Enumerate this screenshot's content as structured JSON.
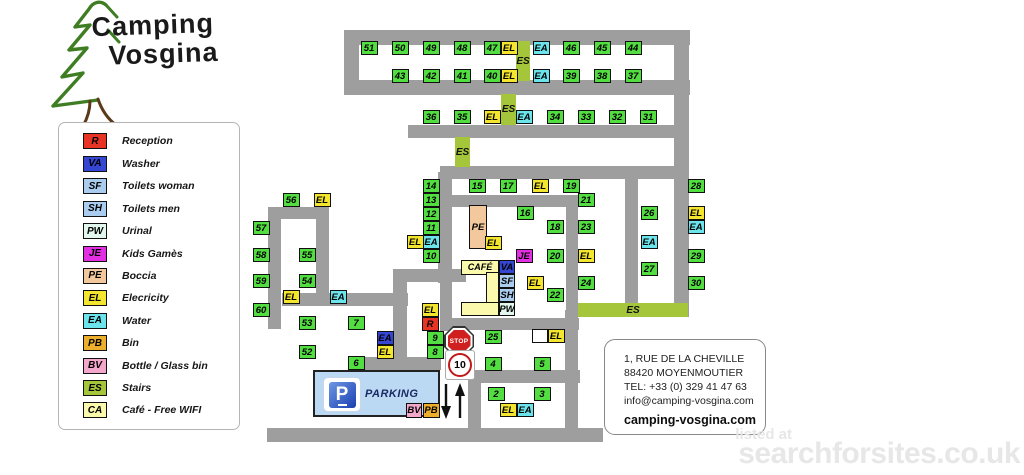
{
  "logo": {
    "line1": "Camping",
    "line2": "Vosgina"
  },
  "legend": {
    "items": [
      {
        "code": "R",
        "type": "R",
        "label": "Reception"
      },
      {
        "code": "VA",
        "type": "VA",
        "label": "Washer"
      },
      {
        "code": "SF",
        "type": "SF",
        "label": "Toilets woman"
      },
      {
        "code": "SH",
        "type": "SH",
        "label": "Toilets men"
      },
      {
        "code": "PW",
        "type": "PW",
        "label": "Urinal"
      },
      {
        "code": "JE",
        "type": "JE",
        "label": "Kids Gamès"
      },
      {
        "code": "PE",
        "type": "PE",
        "label": "Boccia"
      },
      {
        "code": "EL",
        "type": "EL",
        "label": "Elecricity"
      },
      {
        "code": "EA",
        "type": "EA",
        "label": "Water"
      },
      {
        "code": "PB",
        "type": "PB",
        "label": "Bin"
      },
      {
        "code": "BV",
        "type": "BV",
        "label": "Bottle / Glass bin"
      },
      {
        "code": "ES",
        "type": "ES",
        "label": "Stairs"
      },
      {
        "code": "CA",
        "type": "CA",
        "label": "Café - Free WIFI"
      }
    ]
  },
  "map": {
    "roads": [
      [
        344,
        30,
        346,
        15
      ],
      [
        344,
        80,
        346,
        15
      ],
      [
        344,
        30,
        15,
        65
      ],
      [
        674,
        30,
        15,
        287
      ],
      [
        408,
        125,
        280,
        13
      ],
      [
        440,
        166,
        248,
        13
      ],
      [
        625,
        172,
        13,
        131
      ],
      [
        452,
        195,
        127,
        12
      ],
      [
        566,
        195,
        12,
        135
      ],
      [
        440,
        318,
        139,
        12
      ],
      [
        438,
        172,
        14,
        111
      ],
      [
        393,
        269,
        73,
        13
      ],
      [
        393,
        276,
        14,
        95
      ],
      [
        282,
        293,
        126,
        13
      ],
      [
        268,
        207,
        61,
        12
      ],
      [
        268,
        207,
        13,
        122
      ],
      [
        316,
        207,
        13,
        99
      ],
      [
        352,
        357,
        89,
        13
      ],
      [
        440,
        269,
        12,
        62
      ],
      [
        565,
        310,
        13,
        126
      ],
      [
        468,
        370,
        112,
        13
      ],
      [
        468,
        377,
        13,
        58
      ],
      [
        267,
        428,
        336,
        14
      ]
    ],
    "stairs": [
      {
        "x": 516,
        "y": 41,
        "w": 14,
        "h": 40,
        "label": "ES"
      },
      {
        "x": 501,
        "y": 94,
        "w": 15,
        "h": 31,
        "label": "ES"
      },
      {
        "x": 455,
        "y": 137,
        "w": 15,
        "h": 30,
        "label": "ES"
      },
      {
        "x": 578,
        "y": 303,
        "w": 110,
        "h": 14,
        "label": "ES"
      }
    ],
    "boxes": [
      {
        "l": "51",
        "t": "P",
        "x": 369,
        "y": 48
      },
      {
        "l": "50",
        "t": "P",
        "x": 400,
        "y": 48
      },
      {
        "l": "49",
        "t": "P",
        "x": 431,
        "y": 48
      },
      {
        "l": "48",
        "t": "P",
        "x": 462,
        "y": 48
      },
      {
        "l": "47",
        "t": "P",
        "x": 492,
        "y": 48
      },
      {
        "l": "EL",
        "t": "EL",
        "x": 509,
        "y": 48
      },
      {
        "l": "EA",
        "t": "EA",
        "x": 541,
        "y": 48
      },
      {
        "l": "46",
        "t": "P",
        "x": 571,
        "y": 48
      },
      {
        "l": "45",
        "t": "P",
        "x": 602,
        "y": 48
      },
      {
        "l": "44",
        "t": "P",
        "x": 633,
        "y": 48
      },
      {
        "l": "43",
        "t": "P",
        "x": 400,
        "y": 76
      },
      {
        "l": "42",
        "t": "P",
        "x": 431,
        "y": 76
      },
      {
        "l": "41",
        "t": "P",
        "x": 462,
        "y": 76
      },
      {
        "l": "40",
        "t": "P",
        "x": 492,
        "y": 76
      },
      {
        "l": "EL",
        "t": "EL",
        "x": 509,
        "y": 76
      },
      {
        "l": "EA",
        "t": "EA",
        "x": 541,
        "y": 76
      },
      {
        "l": "39",
        "t": "P",
        "x": 571,
        "y": 76
      },
      {
        "l": "38",
        "t": "P",
        "x": 602,
        "y": 76
      },
      {
        "l": "37",
        "t": "P",
        "x": 633,
        "y": 76
      },
      {
        "l": "36",
        "t": "P",
        "x": 431,
        "y": 117
      },
      {
        "l": "35",
        "t": "P",
        "x": 462,
        "y": 117
      },
      {
        "l": "EL",
        "t": "EL",
        "x": 492,
        "y": 117
      },
      {
        "l": "EA",
        "t": "EA",
        "x": 524,
        "y": 117
      },
      {
        "l": "34",
        "t": "P",
        "x": 555,
        "y": 117
      },
      {
        "l": "33",
        "t": "P",
        "x": 586,
        "y": 117
      },
      {
        "l": "32",
        "t": "P",
        "x": 617,
        "y": 117
      },
      {
        "l": "31",
        "t": "P",
        "x": 648,
        "y": 117
      },
      {
        "l": "14",
        "t": "P",
        "x": 431,
        "y": 186
      },
      {
        "l": "15",
        "t": "P",
        "x": 477,
        "y": 186
      },
      {
        "l": "17",
        "t": "P",
        "x": 508,
        "y": 186
      },
      {
        "l": "EL",
        "t": "EL",
        "x": 540,
        "y": 186
      },
      {
        "l": "19",
        "t": "P",
        "x": 571,
        "y": 186
      },
      {
        "l": "28",
        "t": "P",
        "x": 696,
        "y": 186
      },
      {
        "l": "13",
        "t": "P",
        "x": 431,
        "y": 200
      },
      {
        "l": "21",
        "t": "P",
        "x": 586,
        "y": 200
      },
      {
        "l": "56",
        "t": "P",
        "x": 291,
        "y": 200
      },
      {
        "l": "EL",
        "t": "EL",
        "x": 322,
        "y": 200
      },
      {
        "l": "12",
        "t": "P",
        "x": 431,
        "y": 214
      },
      {
        "l": "16",
        "t": "P",
        "x": 525,
        "y": 213
      },
      {
        "l": "26",
        "t": "P",
        "x": 649,
        "y": 213
      },
      {
        "l": "EL",
        "t": "EL",
        "x": 696,
        "y": 213
      },
      {
        "l": "11",
        "t": "P",
        "x": 431,
        "y": 228
      },
      {
        "l": "18",
        "t": "P",
        "x": 555,
        "y": 227
      },
      {
        "l": "23",
        "t": "P",
        "x": 586,
        "y": 227
      },
      {
        "l": "EA",
        "t": "EA",
        "x": 696,
        "y": 227
      },
      {
        "l": "57",
        "t": "P",
        "x": 261,
        "y": 228
      },
      {
        "l": "PE",
        "t": "PE",
        "x": 478,
        "y": 227,
        "w": 18,
        "h": 44
      },
      {
        "l": "EL",
        "t": "EL",
        "x": 415,
        "y": 242
      },
      {
        "l": "EA",
        "t": "EA",
        "x": 431,
        "y": 242
      },
      {
        "l": "EA",
        "t": "EA",
        "x": 649,
        "y": 242
      },
      {
        "l": "EL",
        "t": "EL",
        "x": 493,
        "y": 243
      },
      {
        "l": "10",
        "t": "P",
        "x": 431,
        "y": 256
      },
      {
        "l": "JE",
        "t": "JE",
        "x": 524,
        "y": 256
      },
      {
        "l": "20",
        "t": "P",
        "x": 555,
        "y": 256
      },
      {
        "l": "EL",
        "t": "EL",
        "x": 586,
        "y": 256
      },
      {
        "l": "29",
        "t": "P",
        "x": 696,
        "y": 256
      },
      {
        "l": "58",
        "t": "P",
        "x": 261,
        "y": 255
      },
      {
        "l": "55",
        "t": "P",
        "x": 307,
        "y": 255
      },
      {
        "l": "CAFÉ",
        "t": "CA",
        "x": 480,
        "y": 267,
        "w": 38,
        "h": 15
      },
      {
        "l": "VA",
        "t": "VA",
        "x": 507,
        "y": 267,
        "w": 16,
        "h": 14
      },
      {
        "l": "27",
        "t": "P",
        "x": 649,
        "y": 269
      },
      {
        "l": "59",
        "t": "P",
        "x": 261,
        "y": 281
      },
      {
        "l": "54",
        "t": "P",
        "x": 307,
        "y": 281
      },
      {
        "l": "SF",
        "t": "SF",
        "x": 507,
        "y": 281,
        "w": 16,
        "h": 14
      },
      {
        "l": "EL",
        "t": "EL",
        "x": 535,
        "y": 283
      },
      {
        "l": "24",
        "t": "P",
        "x": 586,
        "y": 283
      },
      {
        "l": "30",
        "t": "P",
        "x": 696,
        "y": 283
      },
      {
        "l": "",
        "t": "CA",
        "x": 492,
        "y": 288,
        "w": 13,
        "h": 32
      },
      {
        "l": "EL",
        "t": "EL",
        "x": 291,
        "y": 297
      },
      {
        "l": "EA",
        "t": "EA",
        "x": 338,
        "y": 297
      },
      {
        "l": "SH",
        "t": "SH",
        "x": 507,
        "y": 295,
        "w": 16,
        "h": 14
      },
      {
        "l": "22",
        "t": "P",
        "x": 555,
        "y": 295
      },
      {
        "l": "60",
        "t": "P",
        "x": 261,
        "y": 310
      },
      {
        "l": "EL",
        "t": "EL",
        "x": 430,
        "y": 310
      },
      {
        "l": "",
        "t": "CA",
        "x": 480,
        "y": 309,
        "w": 38,
        "h": 14
      },
      {
        "l": "PW",
        "t": "PW",
        "x": 507,
        "y": 309,
        "w": 16,
        "h": 14
      },
      {
        "l": "53",
        "t": "P",
        "x": 307,
        "y": 323
      },
      {
        "l": "7",
        "t": "P",
        "x": 356,
        "y": 323
      },
      {
        "l": "R",
        "t": "R",
        "x": 430,
        "y": 324
      },
      {
        "l": "25",
        "t": "P",
        "x": 493,
        "y": 337
      },
      {
        "l": "",
        "t": "WHITE",
        "x": 540,
        "y": 336,
        "w": 16
      },
      {
        "l": "EL",
        "t": "EL",
        "x": 556,
        "y": 336
      },
      {
        "l": "EA",
        "t": "EAB",
        "x": 385,
        "y": 338
      },
      {
        "l": "9",
        "t": "P",
        "x": 435,
        "y": 338
      },
      {
        "l": "EL",
        "t": "EL",
        "x": 385,
        "y": 352
      },
      {
        "l": "8",
        "t": "P",
        "x": 435,
        "y": 352
      },
      {
        "l": "52",
        "t": "P",
        "x": 307,
        "y": 352
      },
      {
        "l": "6",
        "t": "P",
        "x": 356,
        "y": 363
      },
      {
        "l": "4",
        "t": "P",
        "x": 493,
        "y": 364
      },
      {
        "l": "5",
        "t": "P",
        "x": 542,
        "y": 364
      },
      {
        "l": "2",
        "t": "P",
        "x": 496,
        "y": 394
      },
      {
        "l": "3",
        "t": "P",
        "x": 542,
        "y": 394
      },
      {
        "l": "EL",
        "t": "EL",
        "x": 508,
        "y": 410
      },
      {
        "l": "EA",
        "t": "EA",
        "x": 525,
        "y": 410
      },
      {
        "l": "BV",
        "t": "BV",
        "x": 414,
        "y": 410,
        "w": 16,
        "h": 15
      },
      {
        "l": "PB",
        "t": "PB",
        "x": 431,
        "y": 410,
        "w": 17,
        "h": 15
      }
    ],
    "parking": {
      "label": "PARKING"
    },
    "stop_label": "STOP",
    "speed_label": "10"
  },
  "contact": {
    "lines": [
      "1, RUE DE LA CHEVILLE",
      "88420 MOYENMOUTIER",
      "TEL: +33 (0) 329 41 47 63",
      "info@camping-vosgina.com"
    ],
    "website": "camping-vosgina.com"
  },
  "watermark": {
    "line1": "listed at",
    "line2": "searchforsites.co.uk"
  }
}
